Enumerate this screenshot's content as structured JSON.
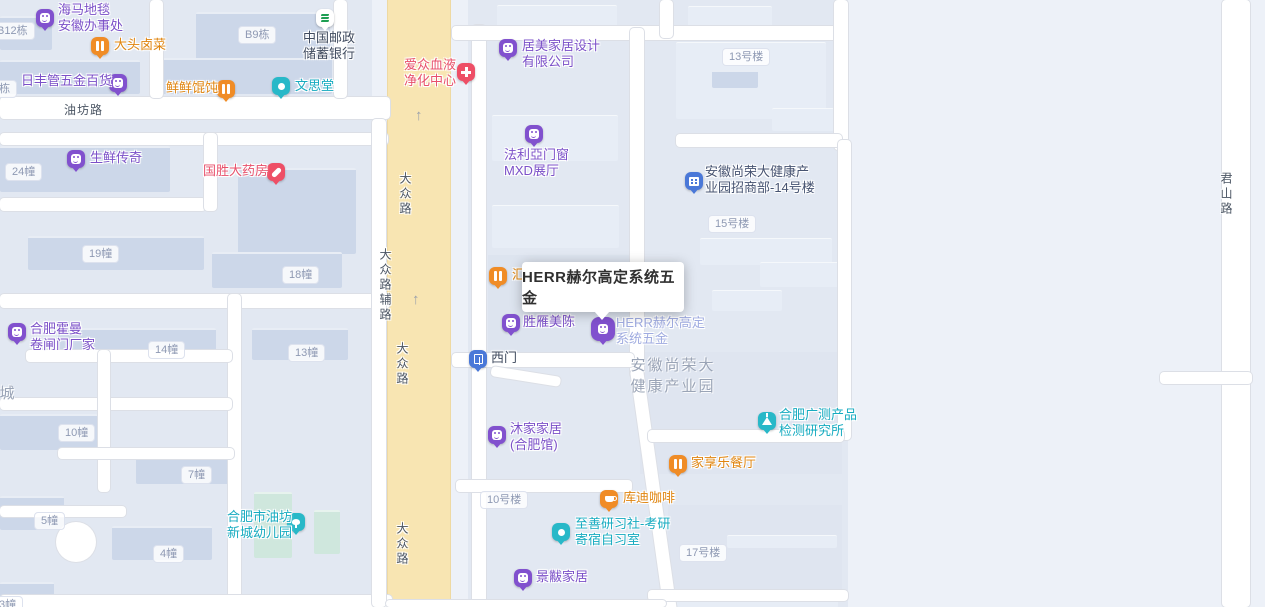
{
  "map": {
    "background": "#edf1f8",
    "accent_colors": {
      "purple": "#8151ce",
      "orange": "#f08c26",
      "teal": "#28b8c8",
      "red": "#ee4f66",
      "blue": "#4a78d8",
      "bank_green": "#1d9e53",
      "road_yellow": "#f8e5b2",
      "text_purple": "#7b50c8",
      "text_orange": "#e0850f",
      "text_teal": "#16abc0",
      "text_pink": "#e8506b",
      "text_dark": "#3f4a5e",
      "text_selected": "#9fabe0"
    },
    "blocks": [
      {
        "x": 0,
        "y": 0,
        "w": 372,
        "h": 607,
        "c": "#e2e8f2"
      },
      {
        "x": 468,
        "y": 0,
        "w": 380,
        "h": 607,
        "c": "#e2e8f2"
      },
      {
        "x": 488,
        "y": 255,
        "w": 144,
        "h": 100,
        "c": "#dde4ef"
      },
      {
        "x": 640,
        "y": 352,
        "w": 202,
        "h": 122,
        "c": "#dfe5f0"
      },
      {
        "x": 668,
        "y": 505,
        "w": 174,
        "h": 86,
        "c": "#dfe5f0"
      }
    ],
    "buildings": [
      {
        "x": 0,
        "y": 16,
        "w": 52,
        "h": 32
      },
      {
        "x": 196,
        "y": 12,
        "w": 134,
        "h": 46
      },
      {
        "x": 0,
        "y": 60,
        "w": 140,
        "h": 32
      },
      {
        "x": 160,
        "y": 58,
        "w": 172,
        "h": 34
      },
      {
        "x": 0,
        "y": 146,
        "w": 170,
        "h": 44
      },
      {
        "x": 238,
        "y": 168,
        "w": 118,
        "h": 84
      },
      {
        "x": 28,
        "y": 236,
        "w": 176,
        "h": 32
      },
      {
        "x": 212,
        "y": 252,
        "w": 130,
        "h": 34
      },
      {
        "x": 58,
        "y": 328,
        "w": 158,
        "h": 30
      },
      {
        "x": 252,
        "y": 328,
        "w": 96,
        "h": 30
      },
      {
        "x": 0,
        "y": 414,
        "w": 98,
        "h": 34
      },
      {
        "x": 136,
        "y": 452,
        "w": 98,
        "h": 30
      },
      {
        "x": 0,
        "y": 496,
        "w": 64,
        "h": 32
      },
      {
        "x": 112,
        "y": 526,
        "w": 100,
        "h": 32
      },
      {
        "x": 0,
        "y": 582,
        "w": 54,
        "h": 25
      },
      {
        "x": 254,
        "y": 492,
        "w": 38,
        "h": 64,
        "cls": "green"
      },
      {
        "x": 314,
        "y": 510,
        "w": 26,
        "h": 42,
        "cls": "green"
      },
      {
        "x": 497,
        "y": 5,
        "w": 120,
        "h": 22,
        "cls": "lt"
      },
      {
        "x": 492,
        "y": 115,
        "w": 126,
        "h": 45,
        "cls": "lt"
      },
      {
        "x": 492,
        "y": 205,
        "w": 127,
        "h": 42,
        "cls": "lt"
      },
      {
        "x": 676,
        "y": 42,
        "w": 150,
        "h": 76,
        "cls": "lt"
      },
      {
        "x": 688,
        "y": 6,
        "w": 84,
        "h": 20,
        "cls": "lt"
      },
      {
        "x": 712,
        "y": 70,
        "w": 46,
        "h": 16
      },
      {
        "x": 772,
        "y": 108,
        "w": 62,
        "h": 22,
        "cls": "lt"
      },
      {
        "x": 700,
        "y": 238,
        "w": 132,
        "h": 26,
        "cls": "lt"
      },
      {
        "x": 760,
        "y": 262,
        "w": 86,
        "h": 24,
        "cls": "lt"
      },
      {
        "x": 712,
        "y": 290,
        "w": 70,
        "h": 20,
        "cls": "lt"
      },
      {
        "x": 727,
        "y": 535,
        "w": 110,
        "h": 12,
        "cls": "lt"
      },
      {
        "x": 648,
        "y": 600,
        "w": 190,
        "h": 7,
        "cls": "lt"
      }
    ],
    "roads": [
      {
        "x": 0,
        "y": 97,
        "w": 390,
        "h": 22
      },
      {
        "x": 0,
        "y": 133,
        "w": 388,
        "h": 12
      },
      {
        "x": 150,
        "y": 0,
        "w": 13,
        "h": 98
      },
      {
        "x": 334,
        "y": 0,
        "w": 13,
        "h": 98
      },
      {
        "x": 0,
        "y": 198,
        "w": 206,
        "h": 13
      },
      {
        "x": 204,
        "y": 133,
        "w": 13,
        "h": 78
      },
      {
        "x": 0,
        "y": 294,
        "w": 390,
        "h": 14
      },
      {
        "x": 228,
        "y": 294,
        "w": 13,
        "h": 313
      },
      {
        "x": 26,
        "y": 350,
        "w": 206,
        "h": 12
      },
      {
        "x": 0,
        "y": 398,
        "w": 232,
        "h": 12
      },
      {
        "x": 98,
        "y": 350,
        "w": 12,
        "h": 142
      },
      {
        "x": 58,
        "y": 448,
        "w": 176,
        "h": 11
      },
      {
        "x": 0,
        "y": 506,
        "w": 126,
        "h": 11
      },
      {
        "x": 56,
        "y": 522,
        "w": 40,
        "h": 40,
        "cls": "circle-road"
      },
      {
        "x": 0,
        "y": 595,
        "w": 392,
        "h": 12
      },
      {
        "x": 372,
        "y": 119,
        "w": 14,
        "h": 488
      },
      {
        "x": 472,
        "y": 25,
        "w": 14,
        "h": 582
      },
      {
        "x": 452,
        "y": 26,
        "w": 396,
        "h": 14
      },
      {
        "x": 660,
        "y": 0,
        "w": 13,
        "h": 38
      },
      {
        "x": 630,
        "y": 28,
        "w": 14,
        "h": 350
      },
      {
        "x": 630,
        "y": 370,
        "w": 13,
        "h": 248,
        "rot": -8
      },
      {
        "x": 834,
        "y": 0,
        "w": 14,
        "h": 150
      },
      {
        "x": 676,
        "y": 134,
        "w": 166,
        "h": 13
      },
      {
        "x": 838,
        "y": 140,
        "w": 13,
        "h": 300
      },
      {
        "x": 452,
        "y": 353,
        "w": 182,
        "h": 14
      },
      {
        "x": 492,
        "y": 366,
        "w": 70,
        "h": 10,
        "rot": 9
      },
      {
        "x": 456,
        "y": 480,
        "w": 176,
        "h": 12
      },
      {
        "x": 648,
        "y": 430,
        "w": 196,
        "h": 12
      },
      {
        "x": 648,
        "y": 590,
        "w": 200,
        "h": 11
      },
      {
        "x": 386,
        "y": 600,
        "w": 280,
        "h": 7
      },
      {
        "x": 1222,
        "y": 0,
        "w": 28,
        "h": 607
      },
      {
        "x": 1160,
        "y": 372,
        "w": 92,
        "h": 12
      }
    ],
    "yellow_road": {
      "x": 388,
      "y": 0,
      "w": 62,
      "h": 607
    },
    "arrows": [
      {
        "x": 415,
        "y": 107
      },
      {
        "x": 412,
        "y": 291
      }
    ],
    "arrow_glyph": "↑",
    "road_labels": [
      {
        "text": "油坊路",
        "x": 64,
        "y": 101,
        "vertical": false
      },
      {
        "text": "大众路",
        "x": 397,
        "y": 172,
        "vertical": true
      },
      {
        "text": "大众路",
        "x": 394,
        "y": 342,
        "vertical": true
      },
      {
        "text": "大众路",
        "x": 394,
        "y": 522,
        "vertical": true
      },
      {
        "text": "大众路辅路",
        "x": 377,
        "y": 248,
        "vertical": true
      },
      {
        "text": "君山路",
        "x": 1218,
        "y": 172,
        "vertical": true
      }
    ],
    "area_labels": [
      {
        "lines": [
          "安徽尚荣大",
          "健康产业园"
        ],
        "x": 618,
        "y": 354,
        "w": 110
      },
      {
        "lines": [
          "城"
        ],
        "x": -4,
        "y": 382,
        "w": 24
      }
    ],
    "building_labels": [
      {
        "text": "B12栋",
        "x": -10,
        "y": 22
      },
      {
        "text": "7栋",
        "x": -14,
        "y": 80
      },
      {
        "text": "B9栋",
        "x": 238,
        "y": 26
      },
      {
        "text": "13号楼",
        "x": 722,
        "y": 48
      },
      {
        "text": "24幢",
        "x": 5,
        "y": 163
      },
      {
        "text": "15号楼",
        "x": 708,
        "y": 215
      },
      {
        "text": "19幢",
        "x": 82,
        "y": 245
      },
      {
        "text": "18幢",
        "x": 282,
        "y": 266
      },
      {
        "text": "14幢",
        "x": 148,
        "y": 341
      },
      {
        "text": "13幢",
        "x": 288,
        "y": 344
      },
      {
        "text": "10幢",
        "x": 58,
        "y": 424
      },
      {
        "text": "7幢",
        "x": 181,
        "y": 466
      },
      {
        "text": "10号楼",
        "x": 480,
        "y": 491
      },
      {
        "text": "5幢",
        "x": 34,
        "y": 512
      },
      {
        "text": "17号楼",
        "x": 679,
        "y": 544
      },
      {
        "text": "4幢",
        "x": 153,
        "y": 545
      },
      {
        "text": "3幢",
        "x": -8,
        "y": 596
      }
    ],
    "pois": [
      {
        "name": "haima-carpet",
        "icon": "shopping-bag-icon",
        "pin": "#8151ce",
        "px": 45,
        "py": 16,
        "lines": [
          "海马地毯",
          "安徽办事处"
        ],
        "lx": 58,
        "ly": 2,
        "color": "#7b50c8"
      },
      {
        "name": "datou-braised-food",
        "icon": "fork-knife-icon",
        "pin": "#f08c26",
        "px": 100,
        "py": 44,
        "lines": [
          "大头卤菜"
        ],
        "lx": 114,
        "ly": 37,
        "color": "#e0850f"
      },
      {
        "name": "china-post-savings-bank",
        "icon": "postal-bank-icon",
        "pin": "#ffffff",
        "px": 325,
        "py": 16,
        "lines": [
          "中国邮政",
          "储蓄银行"
        ],
        "lx": 303,
        "ly": 30,
        "color": "#3f4a5e"
      },
      {
        "name": "rifeng-hardware-store",
        "icon": "shopping-bag-icon",
        "pin": "#8151ce",
        "px": 118,
        "py": 81,
        "lines": [
          "日丰管五金百货"
        ],
        "lx": 21,
        "ly": 73,
        "color": "#7b50c8"
      },
      {
        "name": "xianxian-wonton",
        "icon": "fork-knife-icon",
        "pin": "#f08c26",
        "px": 226,
        "py": 87,
        "lines": [
          "鲜鲜馄饨"
        ],
        "lx": 166,
        "ly": 80,
        "color": "#e0850f"
      },
      {
        "name": "wensitang",
        "icon": "dot-icon",
        "pin": "#28b8c8",
        "px": 281,
        "py": 84,
        "lines": [
          "文思堂"
        ],
        "lx": 295,
        "ly": 78,
        "color": "#16abc0"
      },
      {
        "name": "aizhong-blood-purification-center",
        "icon": "medical-cross-icon",
        "pin": "#ee4f66",
        "px": 466,
        "py": 70,
        "lines": [
          "爱众血液",
          "净化中心"
        ],
        "lx": 404,
        "ly": 57,
        "color": "#e8506b"
      },
      {
        "name": "jumei-home-design",
        "icon": "shopping-bag-icon",
        "pin": "#8151ce",
        "px": 508,
        "py": 46,
        "lines": [
          "居美家居设计",
          "有限公司"
        ],
        "lx": 522,
        "ly": 38,
        "color": "#7b50c8"
      },
      {
        "name": "shengxian-chuanqi",
        "icon": "shopping-cart-icon",
        "pin": "#8151ce",
        "px": 76,
        "py": 157,
        "lines": [
          "生鲜传奇"
        ],
        "lx": 90,
        "ly": 150,
        "color": "#7b50c8"
      },
      {
        "name": "guosheng-pharmacy",
        "icon": "capsule-icon",
        "pin": "#ee4f66",
        "px": 276,
        "py": 170,
        "lines": [
          "国胜大药房"
        ],
        "lx": 203,
        "ly": 163,
        "color": "#e8506b"
      },
      {
        "name": "faliya-doors-windows",
        "icon": "shopping-bag-icon",
        "pin": "#8151ce",
        "px": 534,
        "py": 132,
        "lines": [
          "法利亞门窗",
          "MXD展厅"
        ],
        "lx": 504,
        "ly": 147,
        "color": "#7b50c8"
      },
      {
        "name": "shangrongda-investment-dept",
        "icon": "building-icon",
        "pin": "#4a78d8",
        "px": 694,
        "py": 179,
        "lines": [
          "安徽尚荣大健康产",
          "业园招商部-14号楼"
        ],
        "lx": 705,
        "ly": 164,
        "color": "#465371"
      },
      {
        "name": "hui-restaurant-partial",
        "icon": "fork-knife-icon",
        "pin": "#f08c26",
        "px": 498,
        "py": 274,
        "lines": [
          "汇"
        ],
        "lx": 512,
        "ly": 267,
        "color": "#e0850f"
      },
      {
        "name": "shengyan-meichen",
        "icon": "shopping-bag-icon",
        "pin": "#8151ce",
        "px": 511,
        "py": 321,
        "lines": [
          "胜雁美陈"
        ],
        "lx": 523,
        "ly": 314,
        "color": "#7b50c8"
      },
      {
        "name": "herr-hardware-selected",
        "icon": "shopping-bag-icon",
        "pin": "#8151ce",
        "px": 603,
        "py": 327,
        "lines": [
          "HERR赫尔高定",
          "系统五金"
        ],
        "lx": 616,
        "ly": 315,
        "color": "#9fabe0",
        "selected": true
      },
      {
        "name": "hefei-huoman-rolling-doors",
        "icon": "shopping-bag-icon",
        "pin": "#8151ce",
        "px": 17,
        "py": 330,
        "lines": [
          "合肥霍曼",
          "卷闸门厂家"
        ],
        "lx": 30,
        "ly": 321,
        "color": "#7b50c8"
      },
      {
        "name": "west-gate",
        "icon": "gate-icon",
        "pin": "#4a78d8",
        "px": 478,
        "py": 357,
        "lines": [
          "西门"
        ],
        "lx": 491,
        "ly": 350,
        "color": "#3f4a5e"
      },
      {
        "name": "mujia-home",
        "icon": "shopping-bag-icon",
        "pin": "#8151ce",
        "px": 497,
        "py": 433,
        "lines": [
          "沐家家居",
          "(合肥馆)"
        ],
        "lx": 510,
        "ly": 421,
        "color": "#7b50c8"
      },
      {
        "name": "guangce-testing-institute",
        "icon": "flask-icon",
        "pin": "#28b8c8",
        "px": 767,
        "py": 419,
        "lines": [
          "合肥广测产品",
          "检测研究所"
        ],
        "lx": 779,
        "ly": 407,
        "color": "#16abc0"
      },
      {
        "name": "jiaxiangle-restaurant",
        "icon": "fork-knife-icon",
        "pin": "#f08c26",
        "px": 678,
        "py": 462,
        "lines": [
          "家享乐餐厅"
        ],
        "lx": 691,
        "ly": 455,
        "color": "#e0850f"
      },
      {
        "name": "kudi-coffee",
        "icon": "coffee-cup-icon",
        "pin": "#f08c26",
        "px": 609,
        "py": 497,
        "lines": [
          "库迪咖啡"
        ],
        "lx": 623,
        "ly": 490,
        "color": "#e0850f"
      },
      {
        "name": "zhishan-study-room",
        "icon": "dot-icon",
        "pin": "#28b8c8",
        "px": 561,
        "py": 530,
        "lines": [
          "至善研习社-考研",
          "寄宿自习室"
        ],
        "lx": 575,
        "ly": 516,
        "color": "#16abc0"
      },
      {
        "name": "youfang-kindergarten",
        "icon": "tree-icon",
        "pin": "#28b8c8",
        "px": 296,
        "py": 520,
        "lines": [
          "合肥市油坊",
          "新城幼儿园"
        ],
        "lx": 227,
        "ly": 509,
        "color": "#16abc0"
      },
      {
        "name": "jingfu-home",
        "icon": "shopping-bag-icon",
        "pin": "#8151ce",
        "px": 523,
        "py": 576,
        "lines": [
          "景黻家居"
        ],
        "lx": 536,
        "ly": 569,
        "color": "#7b50c8"
      }
    ],
    "tooltip": {
      "text": "HERR赫尔高定系统五金",
      "x": 522,
      "y": 262,
      "w": 162,
      "h": 50
    }
  }
}
